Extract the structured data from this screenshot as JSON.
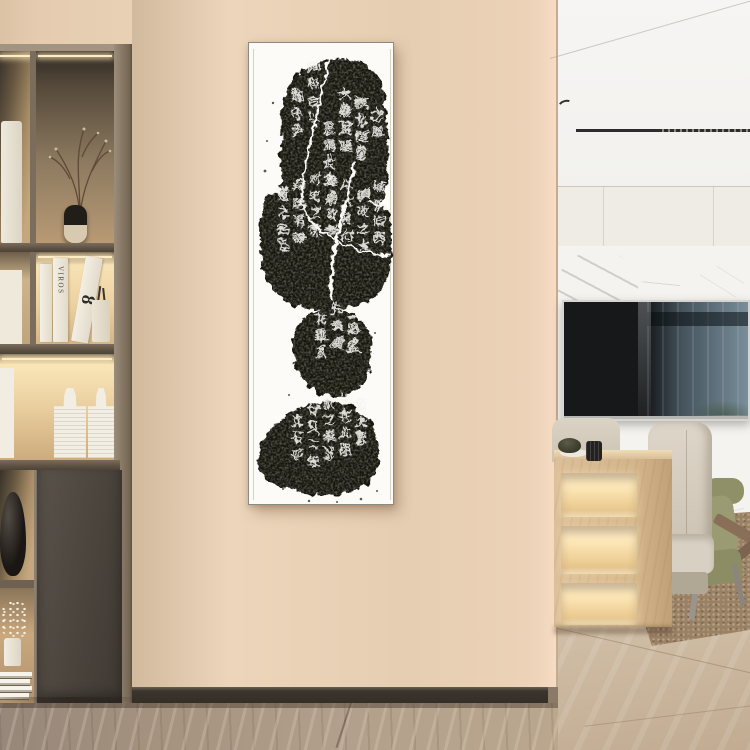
{
  "palette": {
    "wall": "#e8cfb4",
    "wall-edge": "#f3d8be",
    "baseboard": "#3c352d",
    "frame": "#8e8070",
    "frame-light": "#a39482",
    "glow-bright": "#ffedc6",
    "ink": "#171310",
    "paper": "#fcfbf7",
    "ceiling": "#f4f3f0",
    "panel": "#efece6",
    "marble": "#f5f3ef",
    "tv-frame": "#d5d5d3",
    "tv-screen": "#16181a",
    "tv-reflect": "#7e98a8",
    "chair-beige": "#d6cec0",
    "chair-olive": "#94956c",
    "wood-console": "#d9bd96",
    "rug": "#9a8164",
    "floor-left": "#a3917f",
    "floor-right": "#cfbca3"
  },
  "artwork": {
    "type": "ink-rubbing-scroll",
    "orientation": "vertical",
    "ink_color": "#171310",
    "paper_color": "#fcfbf7",
    "columns": [
      {
        "x": 106,
        "y": 64,
        "chars": "壼化度堂"
      },
      {
        "x": 90,
        "y": 56,
        "chars": "大樂盈隆"
      },
      {
        "x": 74,
        "y": 90,
        "chars": "是請佐之"
      },
      {
        "x": 58,
        "y": 28,
        "chars": "御和合以"
      },
      {
        "x": 42,
        "y": 58,
        "chars": "郡守尹"
      },
      {
        "x": 122,
        "y": 76,
        "chars": "之風"
      },
      {
        "x": 124,
        "y": 148,
        "chars": "城攸伯西"
      },
      {
        "x": 108,
        "y": 156,
        "chars": "鎮收之大"
      },
      {
        "x": 92,
        "y": 146,
        "chars": "以大將付"
      },
      {
        "x": 76,
        "y": 142,
        "chars": "建廟政李"
      },
      {
        "x": 60,
        "y": 140,
        "chars": "刺史之杰"
      },
      {
        "x": 44,
        "y": 148,
        "chars": "拜除君諱"
      },
      {
        "x": 28,
        "y": 156,
        "chars": "道之名臣"
      },
      {
        "x": 98,
        "y": 274,
        "chars": "王將盛"
      },
      {
        "x": 82,
        "y": 270,
        "chars": "先費廣"
      },
      {
        "x": 66,
        "y": 280,
        "chars": "花乘系"
      },
      {
        "x": 106,
        "y": 366,
        "chars": "佰大獻"
      },
      {
        "x": 90,
        "y": 360,
        "chars": "往在此明"
      },
      {
        "x": 74,
        "y": 364,
        "chars": "敘之奉述"
      },
      {
        "x": 58,
        "y": 372,
        "chars": "廿又二年"
      },
      {
        "x": 42,
        "y": 382,
        "chars": "立石平"
      }
    ]
  },
  "left_shelf": {
    "book_spine_text": "VIROS",
    "book_numeral": "8"
  }
}
